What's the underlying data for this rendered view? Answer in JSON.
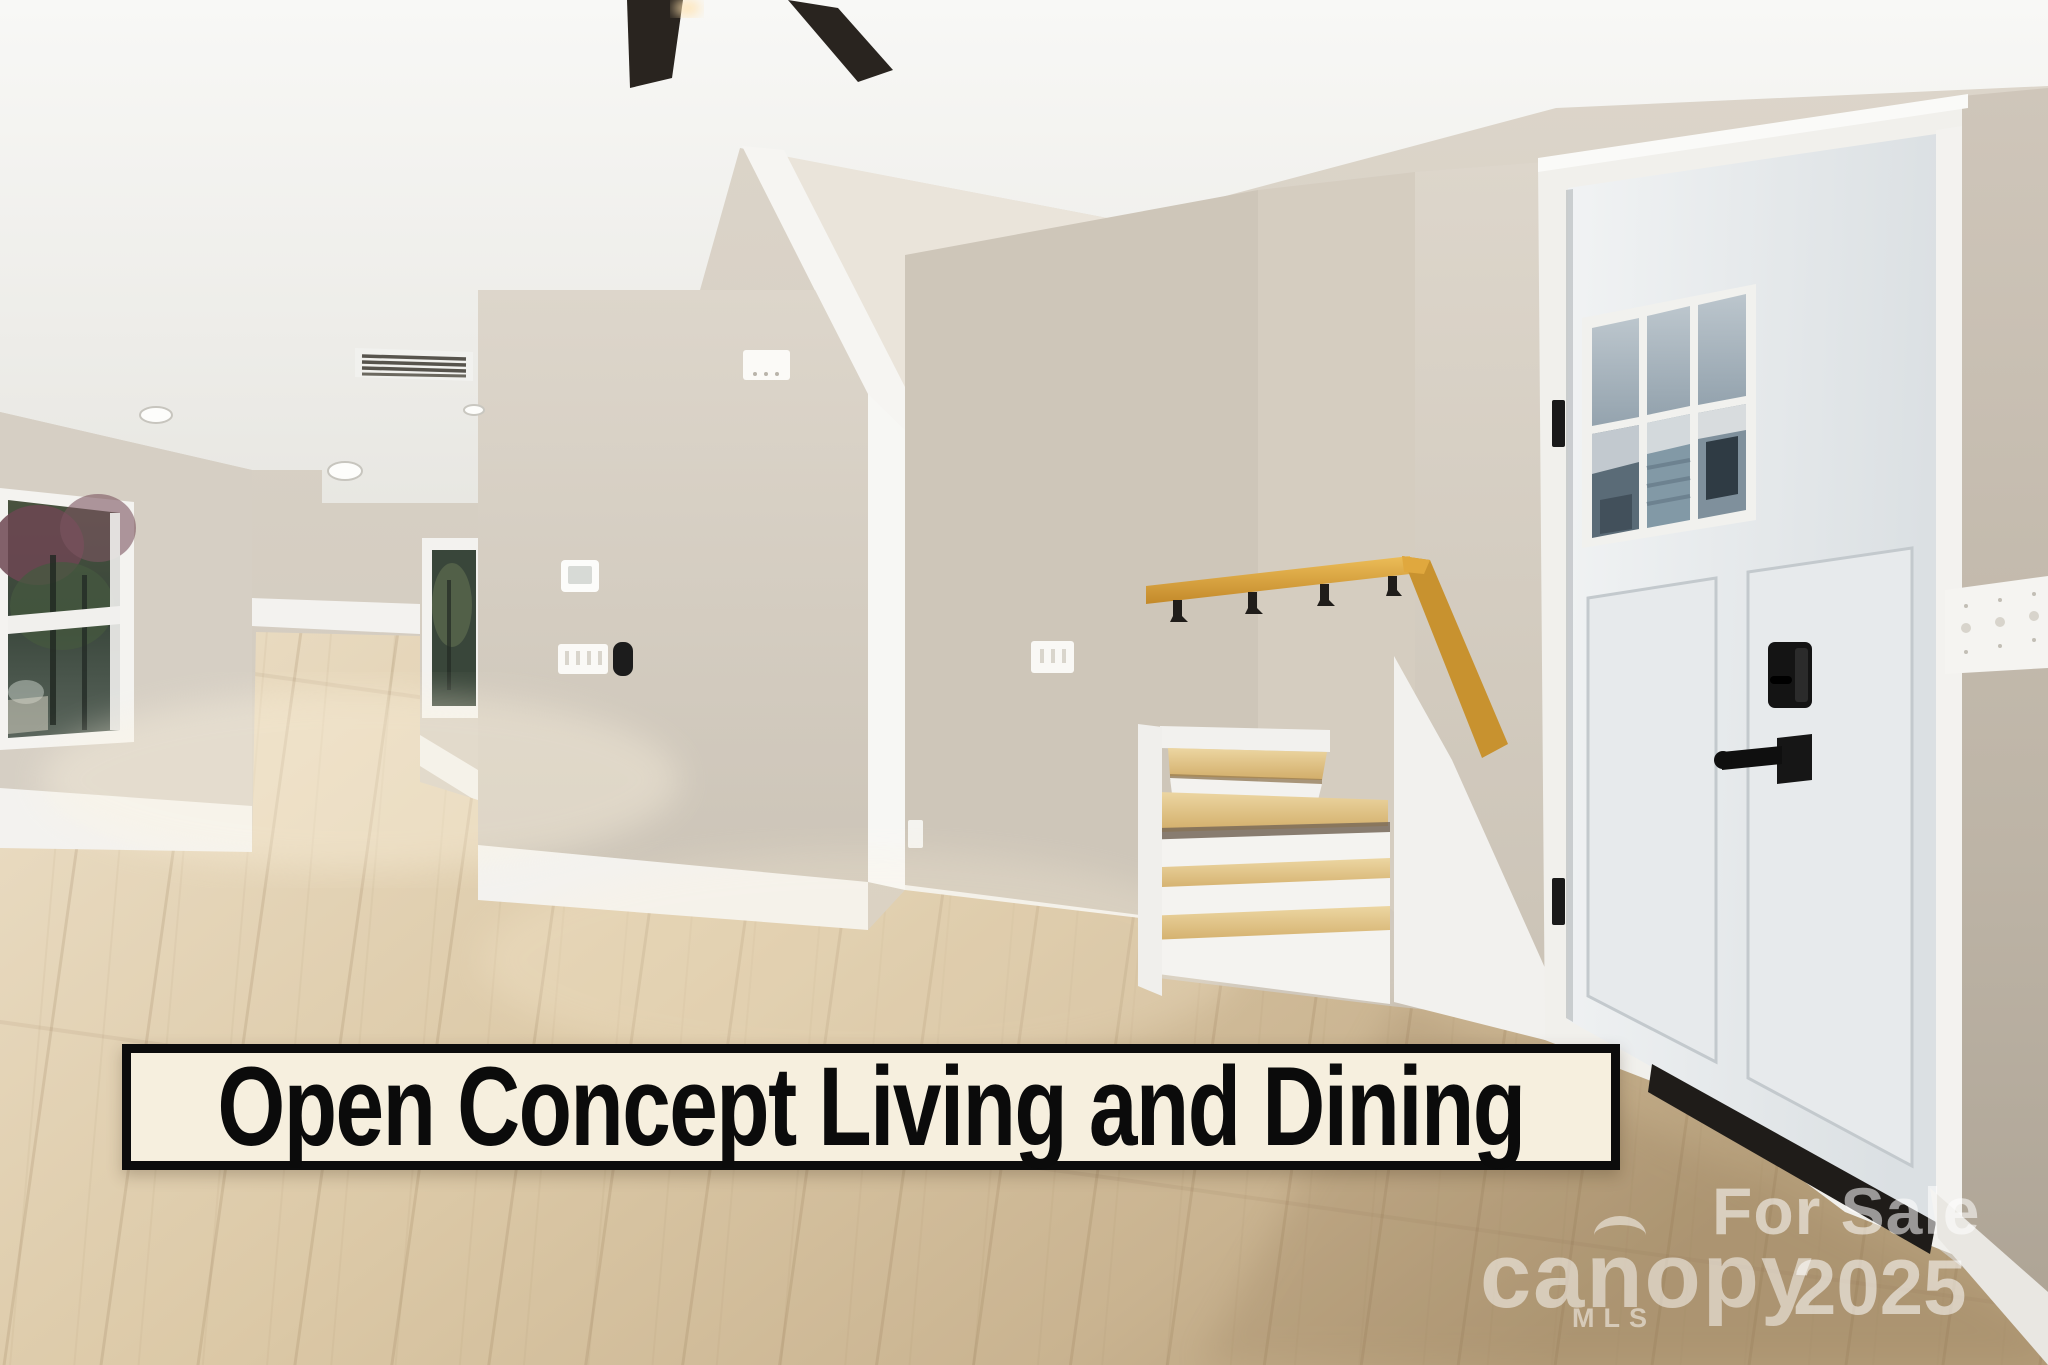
{
  "photo": {
    "subject": "Open concept living and dining room with staircase, oak handrail and white front door",
    "caption_banner": {
      "text": "Open Concept Living and Dining",
      "text_color": "#0b0b0b",
      "background": "#f6efde",
      "border_color": "#0c0c0c"
    },
    "watermark": {
      "for_sale": "For Sale",
      "year": "2025",
      "brand": "canopy",
      "brand_sub": "MLS",
      "color": "#ffffff"
    },
    "palette": {
      "wall_beige": "#d1c9bd",
      "ceiling_white": "#f4f3f0",
      "trim_white": "#f2f1ee",
      "floor_wood": "#ddcaa9",
      "stair_oak": "#d9a33c",
      "door_white": "#e9ecee",
      "hardware_black": "#1a1a1a",
      "fan_blade_black": "#29241f"
    }
  }
}
